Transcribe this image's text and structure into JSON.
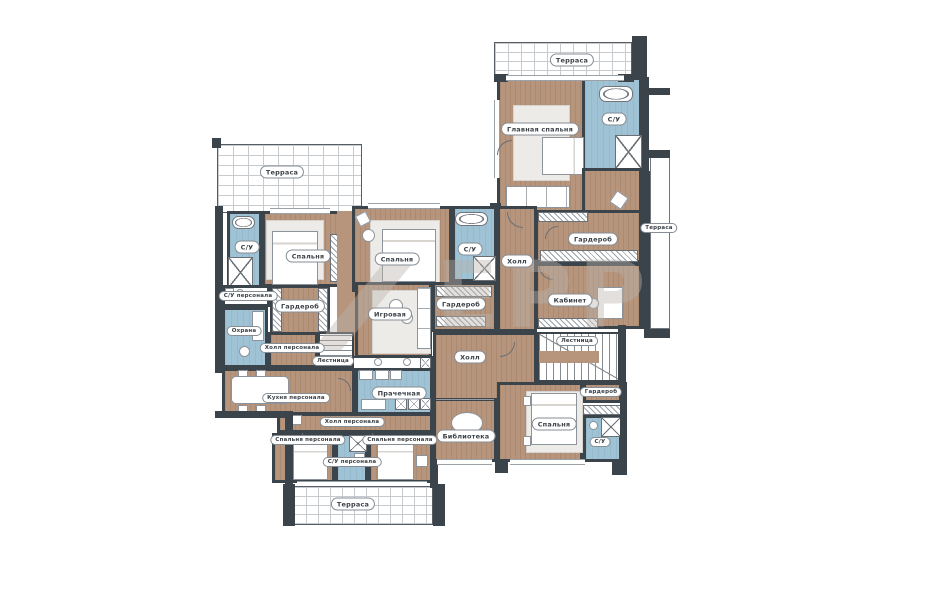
{
  "colors": {
    "floor_wood": "#b6957c",
    "wet_blue": "#9fc3d5",
    "wall_dark": "#3b434b",
    "terrace_grid": "#c7cbce",
    "label_border": "#868d94",
    "label_text": "#3a4046",
    "watermark": "rgba(186,179,171,0.42)"
  },
  "plan": {
    "watermark": "ЕРР",
    "labels": [
      {
        "id": "terrace-top-right",
        "text": "Терраса",
        "x": 572,
        "y": 60
      },
      {
        "id": "su-master",
        "text": "С/У",
        "x": 614,
        "y": 119
      },
      {
        "id": "master-bedroom",
        "text": "Главная спальня",
        "x": 540,
        "y": 129
      },
      {
        "id": "terrace-left",
        "text": "Терраса",
        "x": 282,
        "y": 172
      },
      {
        "id": "terrace-right",
        "text": "Терраса",
        "x": 659,
        "y": 228,
        "s": 1
      },
      {
        "id": "su-left",
        "text": "С/У",
        "x": 247,
        "y": 247
      },
      {
        "id": "bedroom-left",
        "text": "Спальня",
        "x": 308,
        "y": 256
      },
      {
        "id": "bedroom-mid",
        "text": "Спальня",
        "x": 397,
        "y": 259
      },
      {
        "id": "su-mid",
        "text": "С/У",
        "x": 470,
        "y": 249
      },
      {
        "id": "hall-top",
        "text": "Холл",
        "x": 517,
        "y": 261
      },
      {
        "id": "wardrobe-right",
        "text": "Гардероб",
        "x": 593,
        "y": 239
      },
      {
        "id": "su-staff-left",
        "text": "С/У персонала",
        "x": 248,
        "y": 296,
        "s": 1
      },
      {
        "id": "wardrobe-left",
        "text": "Гардероб",
        "x": 300,
        "y": 306
      },
      {
        "id": "playroom",
        "text": "Игровая",
        "x": 390,
        "y": 314
      },
      {
        "id": "wardrobe-mid",
        "text": "Гардероб",
        "x": 461,
        "y": 304
      },
      {
        "id": "kabinet",
        "text": "Кабинет",
        "x": 570,
        "y": 300
      },
      {
        "id": "ohrana",
        "text": "Охрана",
        "x": 244,
        "y": 331,
        "s": 1
      },
      {
        "id": "hall-staff-top",
        "text": "Холл персонала",
        "x": 292,
        "y": 348,
        "s": 1
      },
      {
        "id": "stairs-left",
        "text": "Лестница",
        "x": 333,
        "y": 361,
        "s": 1
      },
      {
        "id": "hall-central",
        "text": "Холл",
        "x": 470,
        "y": 357
      },
      {
        "id": "stairs-right",
        "text": "Лестница",
        "x": 577,
        "y": 341,
        "s": 1
      },
      {
        "id": "kitchen-staff",
        "text": "Кухня персонала",
        "x": 296,
        "y": 398,
        "s": 1
      },
      {
        "id": "laundry",
        "text": "Прачечная",
        "x": 399,
        "y": 393
      },
      {
        "id": "wardrobe-bottom-right",
        "text": "Гардероб",
        "x": 601,
        "y": 392,
        "s": 1
      },
      {
        "id": "hall-staff-bottom",
        "text": "Холл персонала",
        "x": 352,
        "y": 422,
        "s": 1
      },
      {
        "id": "staff-bedroom-left",
        "text": "Спальня персонала",
        "x": 308,
        "y": 440,
        "s": 1
      },
      {
        "id": "staff-bedroom-right",
        "text": "Спальня персонала",
        "x": 400,
        "y": 440,
        "s": 1
      },
      {
        "id": "library",
        "text": "Библиотека",
        "x": 466,
        "y": 436
      },
      {
        "id": "bedroom-bottom-right",
        "text": "Спальня",
        "x": 554,
        "y": 424
      },
      {
        "id": "su-bottom-right",
        "text": "С/У",
        "x": 600,
        "y": 442,
        "s": 1
      },
      {
        "id": "su-staff-bottom",
        "text": "С/У персонала",
        "x": 352,
        "y": 462,
        "s": 1
      },
      {
        "id": "terrace-bottom",
        "text": "Терраса",
        "x": 353,
        "y": 504
      }
    ]
  }
}
